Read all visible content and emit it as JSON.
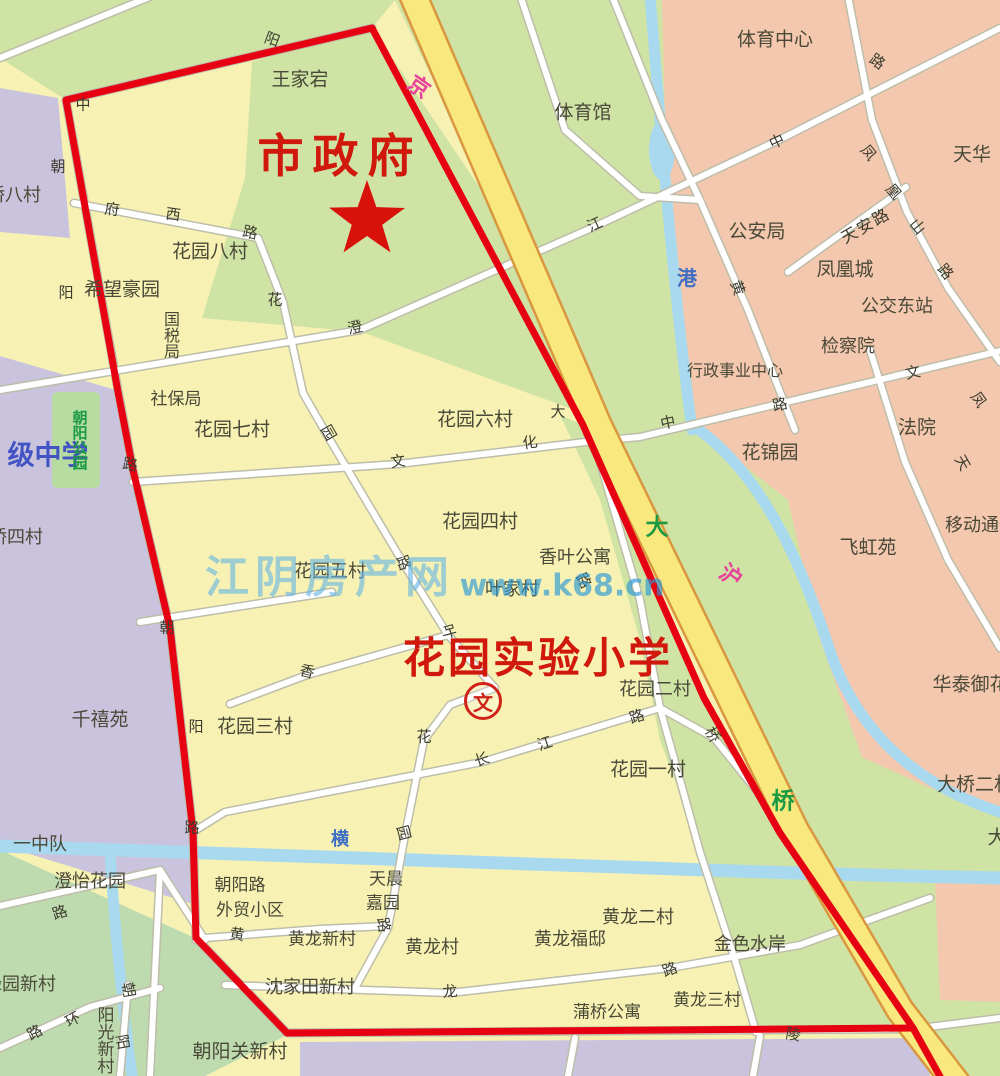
{
  "landmarks": {
    "city_government": "市政府",
    "school_name": "花园实验小学",
    "school_symbol": "文"
  },
  "watermark": {
    "site_name": "江阴房产网",
    "site_url": "www.k68.cn"
  },
  "colors": {
    "boundary_red": "#e60011",
    "highway_yellow": "#f8e87d",
    "residential_yellow": "#f7f2b4",
    "green_area": "#cfe3a5",
    "pink_area": "#f3c8ae",
    "purple_area": "#c9c3de",
    "river_blue": "#a9d9ee",
    "landmark_red_text": "#d0180c",
    "green_text": "#1b9a43",
    "blue_text": "#3e6fc4",
    "pink_text": "#e8429a"
  },
  "labels": [
    {
      "t": "王家宕",
      "x": 300,
      "y": 80,
      "c": "p"
    },
    {
      "t": "体育中心",
      "x": 775,
      "y": 40,
      "c": "p"
    },
    {
      "t": "体育馆",
      "x": 583,
      "y": 113,
      "c": "p"
    },
    {
      "t": "天华",
      "x": 972,
      "y": 155,
      "c": "p"
    },
    {
      "t": "公安局",
      "x": 757,
      "y": 232,
      "c": "p"
    },
    {
      "t": "凤凰城",
      "x": 845,
      "y": 270,
      "c": "p"
    },
    {
      "t": "公交东站",
      "x": 897,
      "y": 307,
      "c": "p",
      "fs": 18
    },
    {
      "t": "检察院",
      "x": 848,
      "y": 347,
      "c": "p",
      "fs": 18
    },
    {
      "t": "行政事业中心",
      "x": 735,
      "y": 371,
      "c": "p",
      "fs": 16
    },
    {
      "t": "法院",
      "x": 917,
      "y": 428,
      "c": "p"
    },
    {
      "t": "花锦园",
      "x": 770,
      "y": 453,
      "c": "p"
    },
    {
      "t": "飞虹苑",
      "x": 868,
      "y": 548,
      "c": "p"
    },
    {
      "t": "移动通信",
      "x": 981,
      "y": 526,
      "c": "p",
      "fs": 18
    },
    {
      "t": "华泰御花园",
      "x": 980,
      "y": 685,
      "c": "p"
    },
    {
      "t": "大桥二村",
      "x": 975,
      "y": 785,
      "c": "p"
    },
    {
      "t": "大",
      "x": 997,
      "y": 838,
      "c": "p"
    },
    {
      "t": "花园八村",
      "x": 210,
      "y": 252,
      "c": "p"
    },
    {
      "t": "希望豪园",
      "x": 122,
      "y": 290,
      "c": "p"
    },
    {
      "t": "国税局",
      "x": 170,
      "y": 335,
      "c": "p",
      "fs": 16,
      "v": true
    },
    {
      "t": "社保局",
      "x": 176,
      "y": 400,
      "c": "p",
      "fs": 17
    },
    {
      "t": "花园七村",
      "x": 232,
      "y": 430,
      "c": "p"
    },
    {
      "t": "花园六村",
      "x": 475,
      "y": 420,
      "c": "p"
    },
    {
      "t": "花园四村",
      "x": 480,
      "y": 522,
      "c": "p"
    },
    {
      "t": "花园五村",
      "x": 330,
      "y": 572,
      "c": "p",
      "fs": 18
    },
    {
      "t": "香叶公寓",
      "x": 575,
      "y": 558,
      "c": "p",
      "fs": 18
    },
    {
      "t": "叶家村",
      "x": 512,
      "y": 590,
      "c": "p",
      "fs": 18
    },
    {
      "t": "花园二村",
      "x": 655,
      "y": 690,
      "c": "p",
      "fs": 18
    },
    {
      "t": "花园一村",
      "x": 648,
      "y": 770,
      "c": "p"
    },
    {
      "t": "花园三村",
      "x": 255,
      "y": 727,
      "c": "p"
    },
    {
      "t": "千禧苑",
      "x": 100,
      "y": 720,
      "c": "p"
    },
    {
      "t": "桥八村",
      "x": 14,
      "y": 196,
      "c": "p",
      "fs": 18
    },
    {
      "t": "桥四村",
      "x": 16,
      "y": 538,
      "c": "p",
      "fs": 18
    },
    {
      "t": "一中队",
      "x": 40,
      "y": 845,
      "c": "p",
      "fs": 18
    },
    {
      "t": "澄怡花园",
      "x": 90,
      "y": 882,
      "c": "p",
      "fs": 18
    },
    {
      "t": "绿园新村",
      "x": 20,
      "y": 985,
      "c": "p",
      "fs": 18
    },
    {
      "t": "阳光新村",
      "x": 103,
      "y": 1040,
      "c": "p",
      "fs": 17,
      "v": true
    },
    {
      "t": "朝阳关新村",
      "x": 240,
      "y": 1052,
      "c": "p"
    },
    {
      "t": "朝阳路",
      "x": 240,
      "y": 886,
      "c": "p",
      "fs": 17
    },
    {
      "t": "外贸小区",
      "x": 250,
      "y": 911,
      "c": "p",
      "fs": 17
    },
    {
      "t": "天晨",
      "x": 386,
      "y": 880,
      "c": "p",
      "fs": 17
    },
    {
      "t": "嘉园",
      "x": 383,
      "y": 904,
      "c": "p",
      "fs": 17
    },
    {
      "t": "黄龙新村",
      "x": 322,
      "y": 940,
      "c": "p",
      "fs": 17
    },
    {
      "t": "黄龙村",
      "x": 432,
      "y": 948,
      "c": "p",
      "fs": 18
    },
    {
      "t": "沈家田新村",
      "x": 310,
      "y": 988,
      "c": "p",
      "fs": 18
    },
    {
      "t": "黄龙福邸",
      "x": 570,
      "y": 940,
      "c": "p",
      "fs": 18
    },
    {
      "t": "黄龙二村",
      "x": 638,
      "y": 918,
      "c": "p",
      "fs": 18
    },
    {
      "t": "金色水岸",
      "x": 750,
      "y": 945,
      "c": "p",
      "fs": 18
    },
    {
      "t": "蒲桥公寓",
      "x": 607,
      "y": 1013,
      "c": "p",
      "fs": 17
    },
    {
      "t": "黄龙三村",
      "x": 707,
      "y": 1001,
      "c": "p",
      "fs": 17
    },
    {
      "t": "级中学",
      "x": 48,
      "y": 456,
      "c": "bb",
      "fs": 27
    },
    {
      "t": "朝阳公园",
      "x": 79,
      "y": 440,
      "c": "gr",
      "fs": 15,
      "v": true
    },
    {
      "t": "大",
      "x": 657,
      "y": 528,
      "c": "gr",
      "fs": 23
    },
    {
      "t": "桥",
      "x": 783,
      "y": 802,
      "c": "gr",
      "fs": 23
    },
    {
      "t": "港",
      "x": 687,
      "y": 278,
      "c": "bl",
      "fs": 20
    },
    {
      "t": "横",
      "x": 340,
      "y": 840,
      "c": "bl",
      "fs": 18
    },
    {
      "t": "京",
      "x": 418,
      "y": 88,
      "c": "pk",
      "fs": 22,
      "rot": 35
    },
    {
      "t": "沪",
      "x": 730,
      "y": 577,
      "c": "pk",
      "fs": 22,
      "rot": 35
    },
    {
      "t": "阳",
      "x": 272,
      "y": 40,
      "c": "r",
      "rot": 20
    },
    {
      "t": "中",
      "x": 83,
      "y": 105,
      "c": "r"
    },
    {
      "t": "朝",
      "x": 58,
      "y": 167,
      "c": "r"
    },
    {
      "t": "阳",
      "x": 66,
      "y": 293,
      "c": "r"
    },
    {
      "t": "路",
      "x": 130,
      "y": 465,
      "c": "r",
      "rot": 10
    },
    {
      "t": "朝",
      "x": 167,
      "y": 628,
      "c": "r"
    },
    {
      "t": "阳",
      "x": 196,
      "y": 727,
      "c": "r"
    },
    {
      "t": "路",
      "x": 192,
      "y": 828,
      "c": "r"
    },
    {
      "t": "府",
      "x": 112,
      "y": 210,
      "c": "r",
      "rot": 8
    },
    {
      "t": "西",
      "x": 173,
      "y": 215,
      "c": "r",
      "rot": 8
    },
    {
      "t": "路",
      "x": 250,
      "y": 233,
      "c": "r",
      "rot": 12
    },
    {
      "t": "花",
      "x": 275,
      "y": 300,
      "c": "r"
    },
    {
      "t": "澄",
      "x": 355,
      "y": 328,
      "c": "r",
      "rot": -12
    },
    {
      "t": "江",
      "x": 595,
      "y": 225,
      "c": "r",
      "rot": -25
    },
    {
      "t": "中",
      "x": 777,
      "y": 142,
      "c": "r",
      "rot": -25
    },
    {
      "t": "路",
      "x": 877,
      "y": 62,
      "c": "r",
      "rot": 35
    },
    {
      "t": "凤",
      "x": 868,
      "y": 153,
      "c": "r",
      "rot": 50
    },
    {
      "t": "凰",
      "x": 893,
      "y": 192,
      "c": "r",
      "rot": 50
    },
    {
      "t": "山",
      "x": 917,
      "y": 227,
      "c": "r",
      "rot": 50
    },
    {
      "t": "路",
      "x": 945,
      "y": 272,
      "c": "r",
      "rot": 50
    },
    {
      "t": "天安路",
      "x": 866,
      "y": 226,
      "c": "r",
      "rot": -30,
      "fs": 16,
      "ls": 2
    },
    {
      "t": "黄",
      "x": 737,
      "y": 288,
      "c": "r",
      "rot": 70
    },
    {
      "t": "中",
      "x": 668,
      "y": 423,
      "c": "r",
      "rot": -12
    },
    {
      "t": "路",
      "x": 780,
      "y": 405,
      "c": "r",
      "rot": -12
    },
    {
      "t": "文",
      "x": 913,
      "y": 373,
      "c": "r",
      "rot": -12
    },
    {
      "t": "凤",
      "x": 978,
      "y": 400,
      "c": "r",
      "rot": 55
    },
    {
      "t": "天",
      "x": 962,
      "y": 463,
      "c": "r",
      "rot": 60
    },
    {
      "t": "文",
      "x": 398,
      "y": 462,
      "c": "r",
      "rot": -8
    },
    {
      "t": "化",
      "x": 530,
      "y": 443,
      "c": "r",
      "rot": -8
    },
    {
      "t": "大",
      "x": 558,
      "y": 412,
      "c": "r"
    },
    {
      "t": "园",
      "x": 328,
      "y": 433,
      "c": "r",
      "rot": 60
    },
    {
      "t": "路",
      "x": 403,
      "y": 563,
      "c": "r",
      "rot": 70
    },
    {
      "t": "叶",
      "x": 448,
      "y": 632,
      "c": "r",
      "rot": 75
    },
    {
      "t": "香",
      "x": 307,
      "y": 672,
      "c": "r",
      "rot": 15
    },
    {
      "t": "花",
      "x": 424,
      "y": 737,
      "c": "r"
    },
    {
      "t": "园",
      "x": 403,
      "y": 833,
      "c": "r",
      "rot": 75
    },
    {
      "t": "路",
      "x": 583,
      "y": 581,
      "c": "r",
      "rot": 60
    },
    {
      "t": "长",
      "x": 482,
      "y": 760,
      "c": "r",
      "rot": -18
    },
    {
      "t": "江",
      "x": 545,
      "y": 744,
      "c": "r",
      "rot": -18
    },
    {
      "t": "路",
      "x": 637,
      "y": 717,
      "c": "r",
      "rot": -18
    },
    {
      "t": "桥",
      "x": 712,
      "y": 735,
      "c": "r",
      "rot": 60
    },
    {
      "t": "路",
      "x": 383,
      "y": 925,
      "c": "r",
      "rot": 80
    },
    {
      "t": "黄",
      "x": 237,
      "y": 935,
      "c": "r",
      "rot": 8
    },
    {
      "t": "龙",
      "x": 450,
      "y": 992,
      "c": "r",
      "rot": -5
    },
    {
      "t": "路",
      "x": 670,
      "y": 970,
      "c": "r",
      "rot": -20
    },
    {
      "t": "陵",
      "x": 793,
      "y": 1035,
      "c": "r",
      "rot": 10
    },
    {
      "t": "环",
      "x": 73,
      "y": 1020,
      "c": "r",
      "rot": -28
    },
    {
      "t": "路",
      "x": 35,
      "y": 1033,
      "c": "r",
      "rot": -28
    },
    {
      "t": "路",
      "x": 60,
      "y": 913,
      "c": "r",
      "rot": -18
    },
    {
      "t": "朝",
      "x": 128,
      "y": 990,
      "c": "r",
      "rot": 80
    },
    {
      "t": "阳",
      "x": 122,
      "y": 1042,
      "c": "r",
      "rot": 80
    }
  ]
}
